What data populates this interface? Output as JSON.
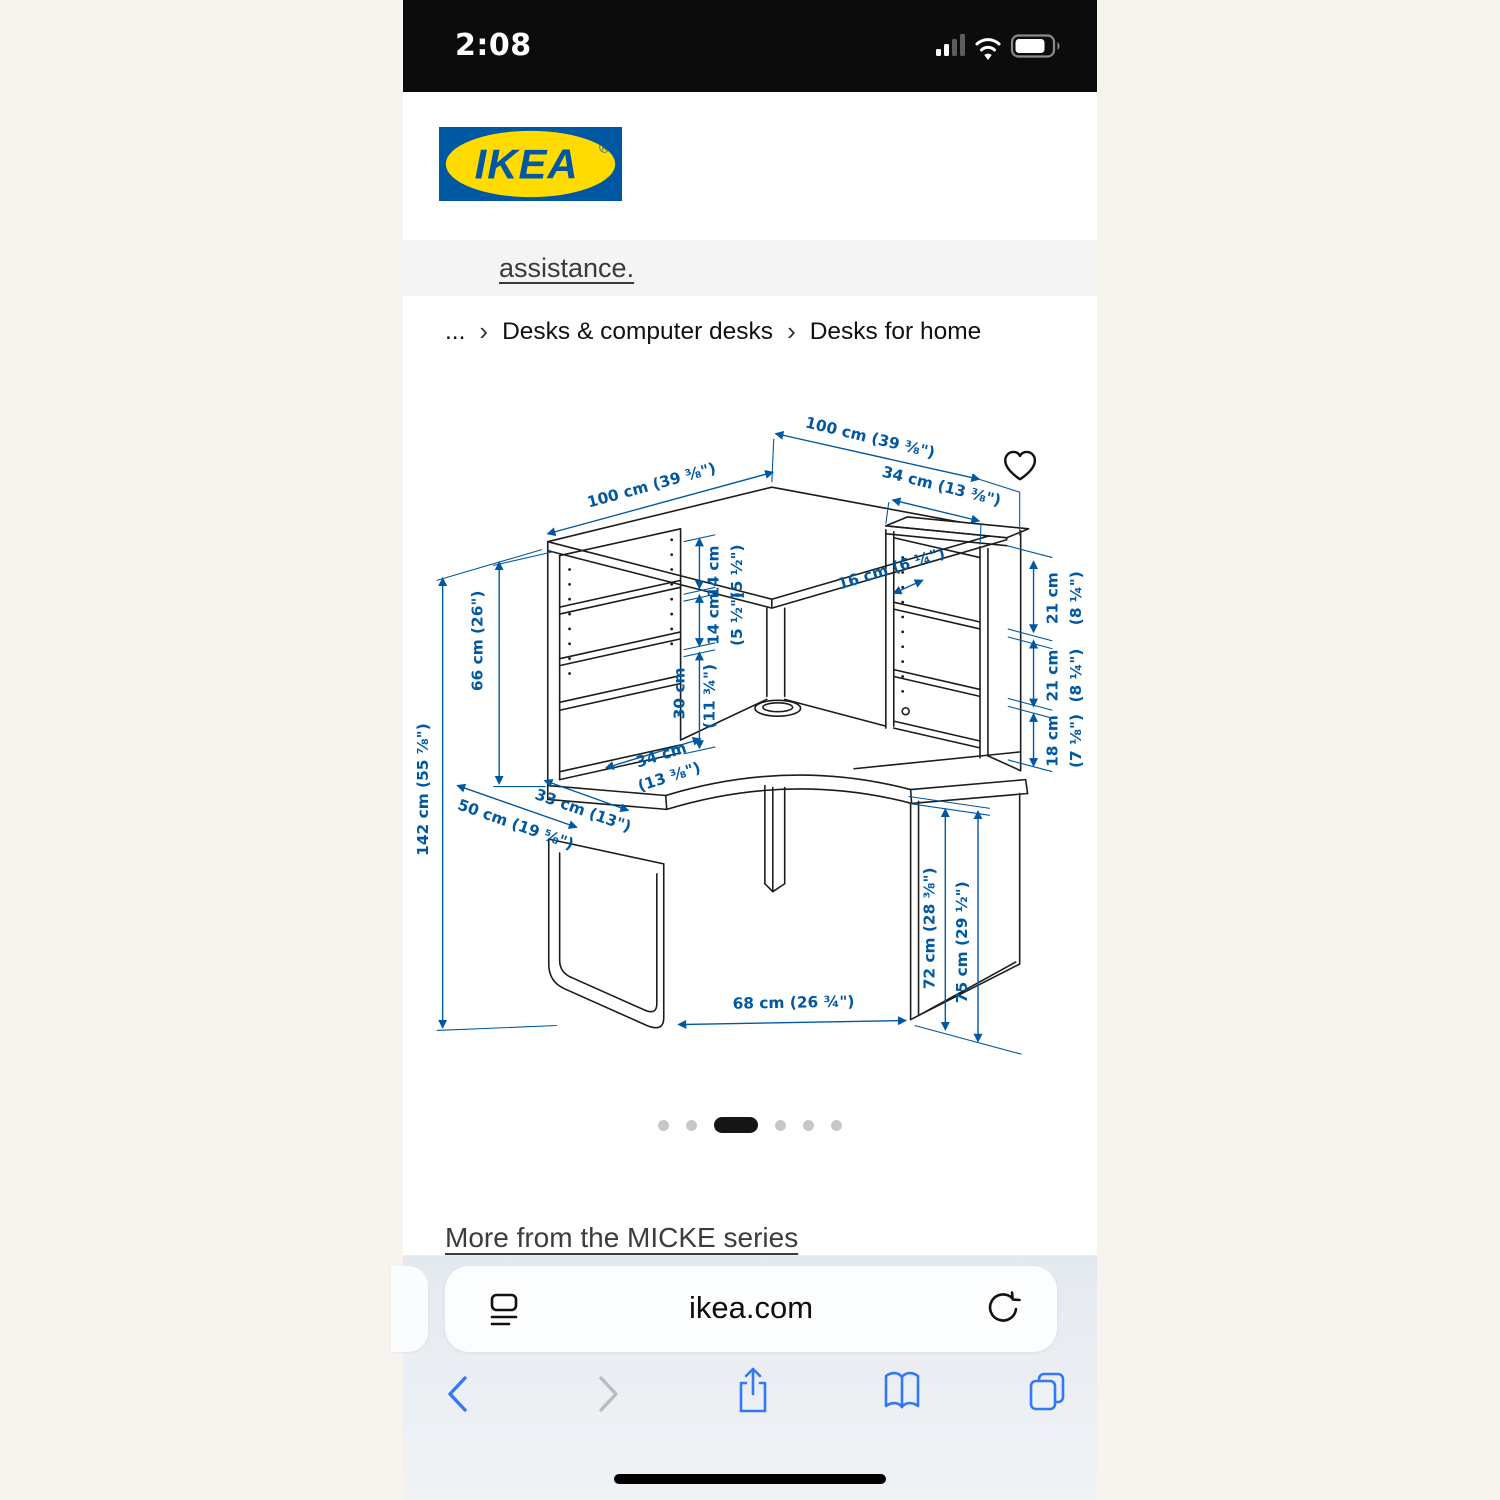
{
  "status_bar": {
    "time": "2:08"
  },
  "header": {
    "logo_text": "IKEA",
    "registered": "®",
    "icons": [
      "search",
      "profile",
      "favorites",
      "cart",
      "menu"
    ]
  },
  "notice_link": "assistance.",
  "breadcrumb": {
    "separator": "›",
    "items": [
      "...",
      "Desks & computer desks",
      "Desks for home"
    ]
  },
  "diagram": {
    "dims": {
      "w_left": "100 cm (39 ⅜\")",
      "w_right": "100 cm (39 ⅜\")",
      "top_unit_w": "34 cm (13 ⅜\")",
      "shelf_depth": "16 cm (6 ¼\")",
      "shelf_h1": {
        "cm": "14 cm",
        "in": "(5 ½\")"
      },
      "shelf_h2": {
        "cm": "14 cm",
        "in": "(5 ½\")"
      },
      "open_h": {
        "cm": "30 cm",
        "in": "(11 ¾\")"
      },
      "right_h1": {
        "cm": "21 cm",
        "in": "(8 ¼\")"
      },
      "right_h2": {
        "cm": "21 cm",
        "in": "(8 ¼\")"
      },
      "right_h3": {
        "cm": "18 cm",
        "in": "(7 ⅛\")"
      },
      "hutch_h": "66 cm (26\")",
      "total_h": "142 cm (55 ⅞\")",
      "left_unit_w": {
        "cm": "34 cm",
        "in": "(13 ⅜\")"
      },
      "side_d1": "33 cm (13\")",
      "side_d2": "50 cm (19 ⅝\")",
      "knee_w": "68 cm (26 ¾\")",
      "desk_h": "72 cm (28 ⅜\")",
      "leg_h": "75 cm (29 ½\")"
    }
  },
  "carousel": {
    "count": 6,
    "active_index": 2
  },
  "more_link": "More from the MICKE series",
  "browser": {
    "url": "ikea.com"
  },
  "colors": {
    "dim_blue": "#0058a3",
    "logo_blue": "#0058a3",
    "logo_yellow": "#ffdb00",
    "safari_blue": "#3478f6",
    "page_bg": "#f7f3ee"
  }
}
